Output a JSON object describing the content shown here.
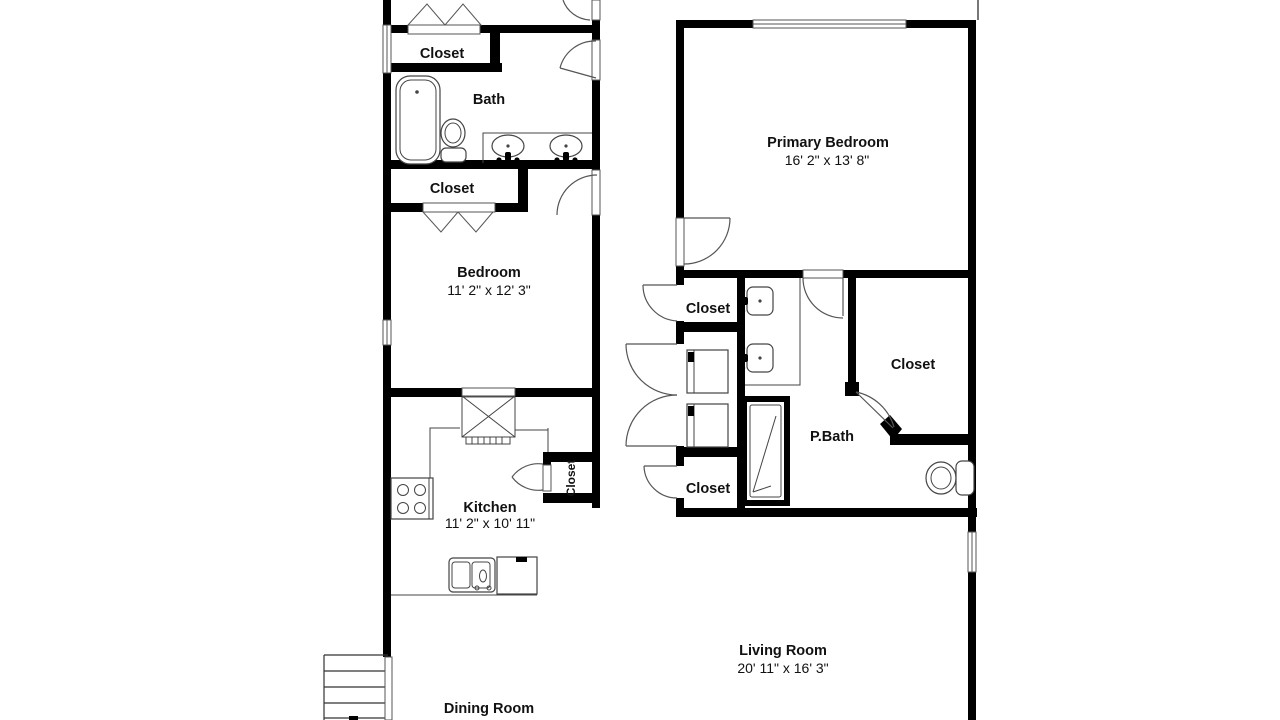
{
  "colors": {
    "wall": "#000000",
    "fixture_line": "#444444",
    "background": "#ffffff",
    "text": "#111111"
  },
  "rooms": {
    "closet_top": {
      "label": "Closet"
    },
    "bath": {
      "label": "Bath"
    },
    "closet_mid": {
      "label": "Closet"
    },
    "bedroom": {
      "label": "Bedroom",
      "dimensions": "11' 2\" x 12' 3\""
    },
    "kitchen": {
      "label": "Kitchen",
      "dimensions": "11' 2\" x 10' 11\""
    },
    "kitchen_closet": {
      "label": "Closet"
    },
    "dining_room": {
      "label": "Dining Room"
    },
    "primary_bedroom": {
      "label": "Primary Bedroom",
      "dimensions": "16' 2\" x 13' 8\""
    },
    "hall_closet": {
      "label": "Closet"
    },
    "linen_closet": {
      "label": "Closet"
    },
    "primary_closet": {
      "label": "Closet"
    },
    "primary_bath": {
      "label": "P.Bath"
    },
    "living_room": {
      "label": "Living Room",
      "dimensions": "20' 11\" x 16' 3\""
    }
  },
  "fixtures": {
    "bathtub": "bathtub",
    "toilet": "toilet",
    "double_vanity": "double-sink vanity",
    "stove": "stove",
    "refrigerator": "refrigerator",
    "kitchen_sink": "kitchen sink",
    "dishwasher": "dishwasher",
    "washer_dryer": "washer/dryer",
    "shower": "shower",
    "stairs": "stairs"
  }
}
